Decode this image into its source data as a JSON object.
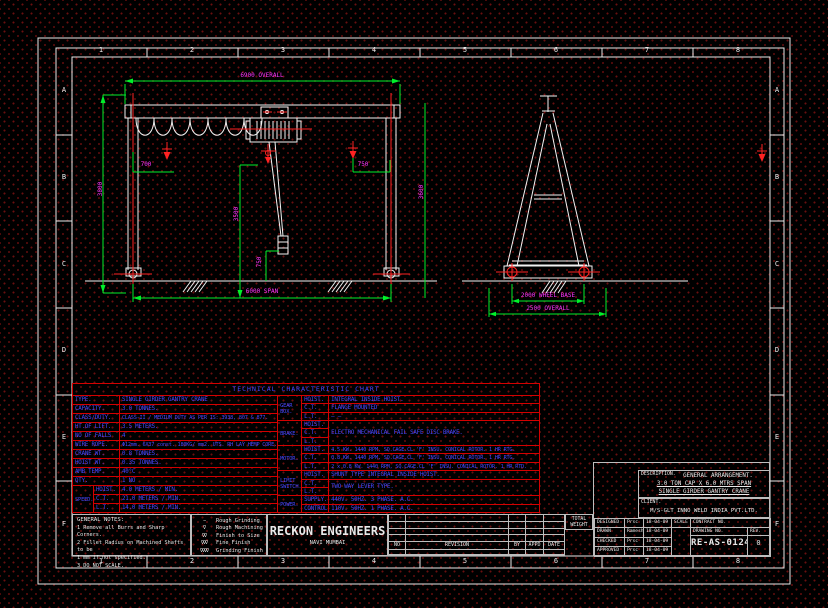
{
  "colors": {
    "background": "#000000",
    "grid_dot": "#6b0f0f",
    "line_white": "#e9e9e9",
    "dim_line_green": "#00f02a",
    "dim_text_magenta": "#ff35ff",
    "table_line_red": "#d40000",
    "table_text_blue": "#4747ff"
  },
  "sheet": {
    "zones_top": [
      "1",
      "2",
      "3",
      "4",
      "5",
      "6",
      "7",
      "8"
    ],
    "zones_bottom": [
      "1",
      "2",
      "3",
      "4",
      "5",
      "6",
      "7",
      "8"
    ],
    "zones_left": [
      "A",
      "B",
      "C",
      "D",
      "E",
      "F"
    ],
    "zones_right": [
      "A",
      "B",
      "C",
      "D",
      "E",
      "F"
    ]
  },
  "dims": {
    "front_overall": "6900 OVERALL",
    "front_span": "6000 SPAN",
    "front_height_left": "3800",
    "front_height_mid": "3500",
    "front_height_right": "3600",
    "front_offset_left": "700",
    "front_offset_right": "750",
    "front_hook": "750",
    "side_wheel_base": "2000 WHEEL BASE",
    "side_overall": "2500 OVERALL"
  },
  "tech_chart": {
    "title": "TECHNICAL CHARACTERISTIC CHART",
    "rows": [
      {
        "label": "TYPE.",
        "value": "SINGLE GIRDER GANTRY CRANE"
      },
      {
        "label": "CAPACITY.",
        "value": "3.0 TONNES."
      },
      {
        "label": "CLASS/DUTY.",
        "value": "CLASS-II / MEDIUM DUTY AS PER IS: 3938, 807 & 877."
      },
      {
        "label": "HT.OF LIFT.",
        "value": "3.5 METERS."
      },
      {
        "label": "NO OF FALLS",
        "value": "4"
      },
      {
        "label": "WIRE ROPE.",
        "value": "Φ12mm. 6X37 const. 180KG/ mm2. UTS. RH LAY HEMP CORE."
      },
      {
        "label": "CRANE WT.",
        "value": "0.8 TONNES."
      },
      {
        "label": "HOIST WT.",
        "value": "0.35 TONNES."
      },
      {
        "label": "AMB TEMP.",
        "value": "40°C"
      },
      {
        "label": "QTY.",
        "value": "1 NO"
      }
    ],
    "speed": {
      "label": "SPEED.",
      "sub": [
        {
          "label": "HOIST.",
          "value": "4.0 METERS / MIN."
        },
        {
          "label": "C.T.",
          "value": "21.0 METERS / MIN."
        },
        {
          "label": "L.T.",
          "value": "14.0 METERS / MIN."
        }
      ]
    },
    "gearbox": {
      "label": "GEAR BOX.",
      "sub": [
        {
          "label": "HOIST.",
          "value": "INTEGRAL INSIDE HOIST."
        },
        {
          "label": "C.T.",
          "value": "FLANGE MOUNTED"
        },
        {
          "label": "L.T.",
          "value": "—  —"
        }
      ]
    },
    "brake": {
      "label": "BRAKE.",
      "subs": [
        "HOIST.",
        "C.T.",
        "L.T."
      ],
      "value": "ELECTRO MECHANICAL FAIL SAFE DISC BRAKE."
    },
    "motor": {
      "label": "MOTOR.",
      "sub": [
        {
          "label": "HOIST.",
          "value": "4.5 KW. 1440 RPM, SQ.CAGE.CL 'F' INSU. CONICAL ROTOR. 1 HR RTG."
        },
        {
          "label": "C.T.",
          "value": "0.8 KW. 1440 RPM, SQ.CAGE.CL 'F' INSU. CONICAL ROTOR. 1 HR RTG."
        },
        {
          "label": "L.T.",
          "value": "2 x 0.8 KW. 1440 RPM, SQ.CAGE.CL 'F' INSU. CONICAL ROTOR. 1 HR RTD."
        }
      ]
    },
    "limit": {
      "label": "LIMIT SWITCH.",
      "subs": [
        "HOIST.",
        "C.T.",
        "L.T."
      ],
      "hoist_value": "SHUNT TYPE INTEGRAL INSIDE HOIST.",
      "ct_lt_value": "TWO WAY LEVER TYPE."
    },
    "power": {
      "label": "POWER.",
      "sub": [
        {
          "label": "SUPPLY.",
          "value": "440V. 50HZ. 3 PHASE. A.C."
        },
        {
          "label": "CONTROL.",
          "value": "110V. 50HZ. 1 PHASE. A.C."
        }
      ]
    }
  },
  "notes": {
    "title": "GENERAL NOTES:",
    "item1": "1   Remove all Burrs and Sharp Corners.",
    "item2": "2   Fillet Radius on Machined Shafts to be\n     1 mm if not specified.",
    "item3": "3   DO NOT SCALE."
  },
  "finish": {
    "rows": [
      {
        "symbol": "∼",
        "label": "Rough Grinding"
      },
      {
        "symbol": "∇",
        "label": "Rough Machining"
      },
      {
        "symbol": "∇∇",
        "label": "Finish to Size"
      },
      {
        "symbol": "∇∇∇",
        "label": "Fine Finish"
      },
      {
        "symbol": "∇∇∇∇",
        "label": "Grinding Finish"
      }
    ]
  },
  "company": {
    "name": "RECKON ENGINEERS",
    "city": "NAVI MUMBAI"
  },
  "revision": {
    "headers": [
      "NO",
      "REVISION",
      "BY",
      "APPD",
      "DATE"
    ]
  },
  "weight_label": "TOTAL WEIGHT",
  "title_block": {
    "description_label": "DESCRIPTION.",
    "description_line1": "GENERAL ARRANGEMENT.",
    "description_line2": "3.0 TON CAP X 6.0 MTRS SPAN",
    "description_line3": "SINGLE GIRDER GANTRY CRANE",
    "client_label": "CLIENT.",
    "client": "M/S-GLT INNO WELD INDIA PVT.LTD.",
    "rows": [
      {
        "role": "DESIGNED",
        "name": "Prsc",
        "date": "18-04-09"
      },
      {
        "role": "DRAWN",
        "name": "Ramesh",
        "date": "18-04-09"
      },
      {
        "role": "CHECKED",
        "name": "Prsc",
        "date": "18-04-09"
      },
      {
        "role": "APPROVED",
        "name": "Prsc",
        "date": "18-04-09"
      }
    ],
    "scale_label": "SCALE",
    "contract_label": "CONTRACT NO.",
    "drawing_no_label": "DRAWING NO.",
    "rev_label": "REV.",
    "drawing_no": "RE-AS-0124",
    "rev": "0"
  }
}
